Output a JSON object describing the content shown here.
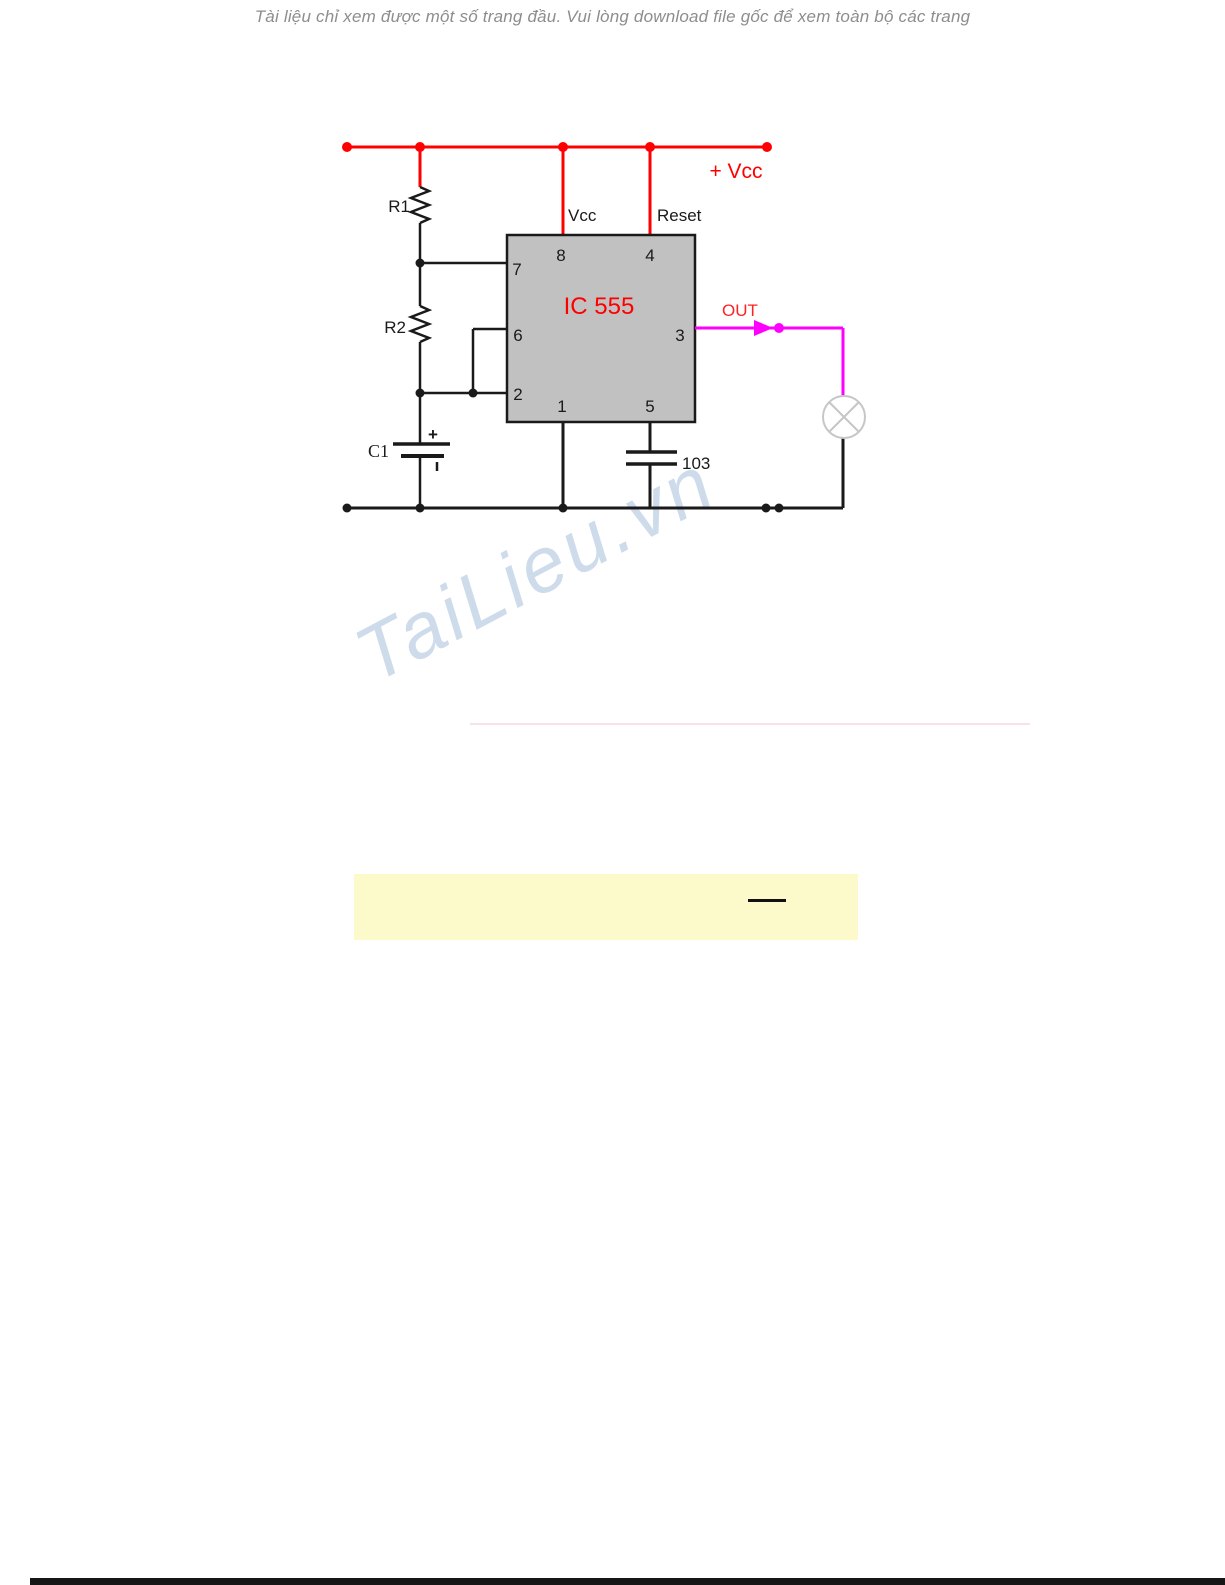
{
  "page": {
    "header_notice": "Tài liệu chỉ xem được một số trang đầu. Vui lòng download file gốc để xem toàn bộ các trang",
    "watermark": "TaiLieu.vn"
  },
  "circuit": {
    "ic_title": "IC 555",
    "labels": {
      "power": "+ Vcc",
      "vcc_pin": "Vcc",
      "reset_pin": "Reset",
      "out": "OUT",
      "r1": "R1",
      "r2": "R2",
      "c1": "C1",
      "c1_polarity": "+",
      "bypass_cap": "103"
    },
    "pins": {
      "pin1": "1",
      "pin2": "2",
      "pin3": "3",
      "pin4": "4",
      "pin5": "5",
      "pin6": "6",
      "pin7": "7",
      "pin8": "8"
    },
    "colors": {
      "power_rail": "#ff0000",
      "ic_label": "#ff0000",
      "output_wire": "#ff00ff",
      "out_label": "#ff2222",
      "ic_fill": "#c1c1c1",
      "wire": "#1a1a1a",
      "lamp_outline": "#c6c6c6",
      "highlight_box": "#fcf9cb"
    }
  }
}
